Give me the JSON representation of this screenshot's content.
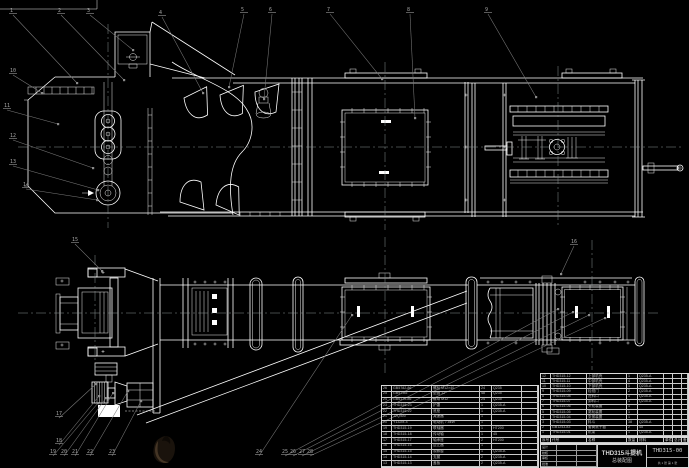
{
  "colors": {
    "background": "#000000",
    "line": "#ffffff",
    "leader": "#7a7a7a",
    "centerline": "#8a9393",
    "table_text": "#b9b9b9"
  },
  "title_block": {
    "product_title": "THD315斗提机",
    "drawing_title": "总装配图",
    "drawing_no": "THD315-00",
    "sheet_info": "共 1 张  第 1 张",
    "sig_labels": [
      "设计",
      "校核",
      "审核",
      "批准"
    ]
  },
  "bom_right": {
    "headers": [
      "序号",
      "代号",
      "名称",
      "数量",
      "材料",
      "单件",
      "总计",
      "备注"
    ],
    "rows": [
      [
        "12",
        "THD315-12",
        "上部机壳",
        "1",
        "Q235-A",
        "",
        "",
        ""
      ],
      [
        "11",
        "THD315-11",
        "中部机壳",
        "4",
        "Q235-A",
        "",
        "",
        ""
      ],
      [
        "10",
        "THD315-10",
        "下部机壳",
        "1",
        "Q235-A",
        "",
        "",
        ""
      ],
      [
        "9",
        "THD315-09",
        "检视门",
        "2",
        "Q235-A",
        "",
        "",
        ""
      ],
      [
        "8",
        "THD315-08",
        "进料口",
        "1",
        "Q235-A",
        "",
        "",
        ""
      ],
      [
        "7",
        "THD315-07",
        "卸料口",
        "1",
        "Q235-A",
        "",
        "",
        ""
      ],
      [
        "6",
        "THD315-06",
        "头轮装置",
        "1",
        "",
        "",
        "",
        ""
      ],
      [
        "5",
        "THD315-05",
        "尾轮装置",
        "1",
        "",
        "",
        "",
        ""
      ],
      [
        "4",
        "THD315-04",
        "张紧装置",
        "1",
        "",
        "",
        "",
        ""
      ],
      [
        "3",
        "THD315-03",
        "料斗",
        "38",
        "Q235-A",
        "",
        "",
        ""
      ],
      [
        "2",
        "GB1243-83",
        "套筒滚子链",
        "2",
        "45",
        "",
        "",
        ""
      ],
      [
        "1",
        "THD315-01",
        "机架",
        "1",
        "Q235-A",
        "",
        "",
        ""
      ]
    ]
  },
  "bom_left": {
    "rows": [
      [
        "26",
        "GB5782-86",
        "螺栓 M12×40",
        "24",
        "Q235",
        ""
      ],
      [
        "25",
        "GB97-85",
        "垫圈 12",
        "48",
        "Q235",
        ""
      ],
      [
        "24",
        "GB6170-86",
        "螺母 M12",
        "24",
        "Q235",
        ""
      ],
      [
        "23",
        "THD315-23",
        "护罩",
        "1",
        "Q235-A",
        ""
      ],
      [
        "22",
        "THD315-22",
        "底座",
        "1",
        "Q235-A",
        ""
      ],
      [
        "21",
        "JZQ400",
        "减速器",
        "1",
        "",
        ""
      ],
      [
        "20",
        "Y132M-4",
        "电动机 7.5kW",
        "1",
        "",
        ""
      ],
      [
        "19",
        "THD315-19",
        "联轴器",
        "1",
        "HT200",
        ""
      ],
      [
        "18",
        "THD315-18",
        "传动轴",
        "1",
        "45",
        ""
      ],
      [
        "17",
        "THD315-17",
        "轴承座",
        "2",
        "HT200",
        ""
      ],
      [
        "16",
        "THD315-16",
        "逆止器",
        "1",
        "",
        ""
      ],
      [
        "15",
        "THD315-15",
        "观察窗",
        "1",
        "Q235-A",
        ""
      ],
      [
        "14",
        "THD315-14",
        "支腿",
        "2",
        "Q235-A",
        ""
      ],
      [
        "13",
        "THD315-13",
        "盖板",
        "2",
        "Q235-A",
        ""
      ]
    ]
  },
  "balloons": [
    {
      "label": "1",
      "x": 10,
      "y": 12,
      "tx": 77,
      "ty": 83
    },
    {
      "label": "2",
      "x": 58,
      "y": 12,
      "tx": 124,
      "ty": 80
    },
    {
      "label": "3",
      "x": 87,
      "y": 12,
      "tx": 133,
      "ty": 50
    },
    {
      "label": "4",
      "x": 159,
      "y": 14,
      "tx": 203,
      "ty": 93
    },
    {
      "label": "5",
      "x": 241,
      "y": 11,
      "tx": 229,
      "ty": 87
    },
    {
      "label": "6",
      "x": 269,
      "y": 11,
      "tx": 264,
      "ty": 99
    },
    {
      "label": "7",
      "x": 327,
      "y": 11,
      "tx": 382,
      "ty": 79
    },
    {
      "label": "8",
      "x": 407,
      "y": 11,
      "tx": 415,
      "ty": 118
    },
    {
      "label": "9",
      "x": 485,
      "y": 11,
      "tx": 536,
      "ty": 97
    },
    {
      "label": "10",
      "x": 10,
      "y": 72,
      "tx": 42,
      "ty": 93
    },
    {
      "label": "11",
      "x": 4,
      "y": 107,
      "tx": 58,
      "ty": 124
    },
    {
      "label": "12",
      "x": 10,
      "y": 137,
      "tx": 93,
      "ty": 168
    },
    {
      "label": "13",
      "x": 10,
      "y": 163,
      "tx": 98,
      "ty": 190
    },
    {
      "label": "14",
      "x": 23,
      "y": 186,
      "tx": 97,
      "ty": 200
    },
    {
      "label": "15",
      "x": 72,
      "y": 241,
      "tx": 102,
      "ty": 271
    },
    {
      "label": "16",
      "x": 571,
      "y": 243,
      "tx": 561,
      "ty": 274
    },
    {
      "label": "17",
      "x": 56,
      "y": 415,
      "tx": 96,
      "ty": 384
    },
    {
      "label": "18",
      "x": 56,
      "y": 442,
      "tx": 99,
      "ty": 396
    },
    {
      "label": "19",
      "x": 50,
      "y": 453,
      "tx": 98,
      "ty": 403
    },
    {
      "label": "20",
      "x": 61,
      "y": 453,
      "tx": 106,
      "ty": 398
    },
    {
      "label": "21",
      "x": 72,
      "y": 453,
      "tx": 113,
      "ty": 393
    },
    {
      "label": "22",
      "x": 87,
      "y": 453,
      "tx": 128,
      "ty": 391
    },
    {
      "label": "23",
      "x": 109,
      "y": 453,
      "tx": 141,
      "ty": 401
    },
    {
      "label": "24",
      "x": 256,
      "y": 453,
      "tx": 352,
      "ty": 315
    },
    {
      "label": "25",
      "x": 282,
      "y": 453,
      "tx": 558,
      "ty": 309
    },
    {
      "label": "26",
      "x": 290,
      "y": 453,
      "tx": 573,
      "ty": 312
    },
    {
      "label": "27",
      "x": 299,
      "y": 453,
      "tx": 589,
      "ty": 315
    },
    {
      "label": "28",
      "x": 307,
      "y": 453,
      "tx": 605,
      "ty": 318
    }
  ]
}
